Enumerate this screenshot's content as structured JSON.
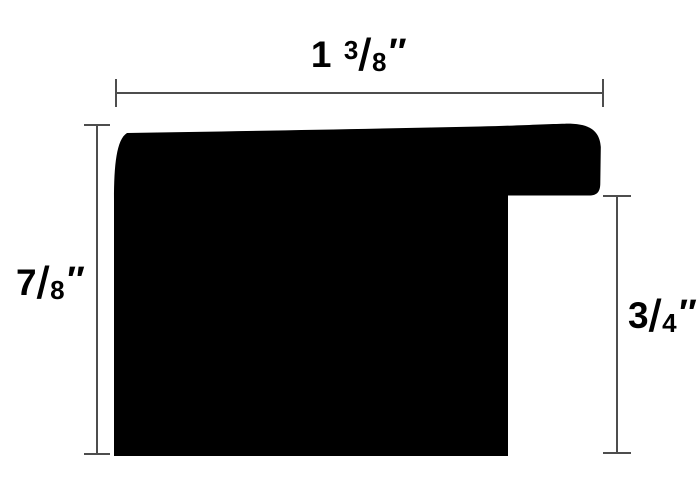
{
  "diagram": {
    "description": "moulding profile cross-section with dimensions",
    "colors": {
      "background": "#ffffff",
      "profile_fill": "#000000",
      "dimension_line": "#4d4d4d",
      "label_text": "#000000"
    },
    "dimensions": {
      "top": {
        "text": "1 3/8″",
        "whole": "1",
        "numerator": "3",
        "slash": "/",
        "denominator": "8",
        "unit": "″"
      },
      "left": {
        "text": "7/8″",
        "numerator": "7",
        "slash": "/",
        "denominator": "8",
        "unit": "″"
      },
      "right": {
        "text": "3/4″",
        "numerator": "3",
        "slash": "/",
        "denominator": "4",
        "unit": "″"
      }
    }
  }
}
